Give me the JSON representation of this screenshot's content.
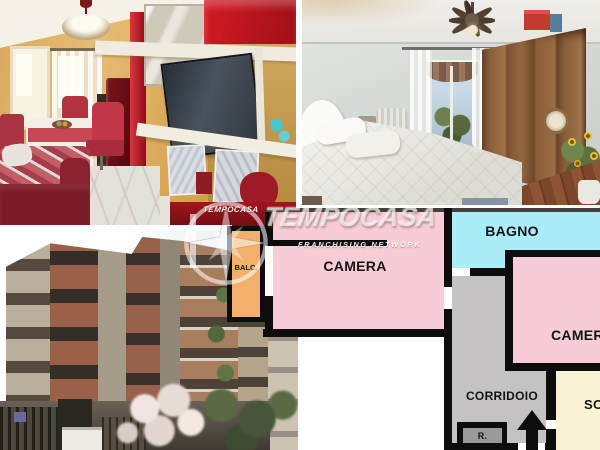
{
  "collage": {
    "photos": [
      {
        "id": "living-room",
        "description": "Living room with red wall unit, TV, dining table and sofa"
      },
      {
        "id": "bedroom",
        "description": "Bedroom with double bed, wooden wardrobe and ceiling fan"
      },
      {
        "id": "building-exterior",
        "description": "Apartment building facade seen from street level"
      }
    ],
    "watermark": {
      "brand": "TEMPOCASA",
      "logo_text": "TEMPOCASA",
      "tagline": "FRANCHISING NETWORK"
    },
    "floor_plan": {
      "background": "#ffffff",
      "wall_color": "#0d0d0d",
      "rooms": [
        {
          "id": "balcony",
          "label": "BALC.",
          "color": "#f2b06c"
        },
        {
          "id": "camera-left",
          "label": "CAMERA",
          "color": "#f7ccd6"
        },
        {
          "id": "bagno",
          "label": "BAGNO",
          "color": "#a9edf9"
        },
        {
          "id": "camera-right",
          "label": "CAMERA",
          "color": "#f7ccd6"
        },
        {
          "id": "corridoio",
          "label": "CORRIDOIO",
          "color": "#c4c2c2"
        },
        {
          "id": "ripostiglio",
          "label": "R.",
          "color": "#9a9a9a"
        },
        {
          "id": "soggiorno",
          "label": "SOGGIORNO",
          "color": "#f8f3d3"
        }
      ]
    }
  }
}
